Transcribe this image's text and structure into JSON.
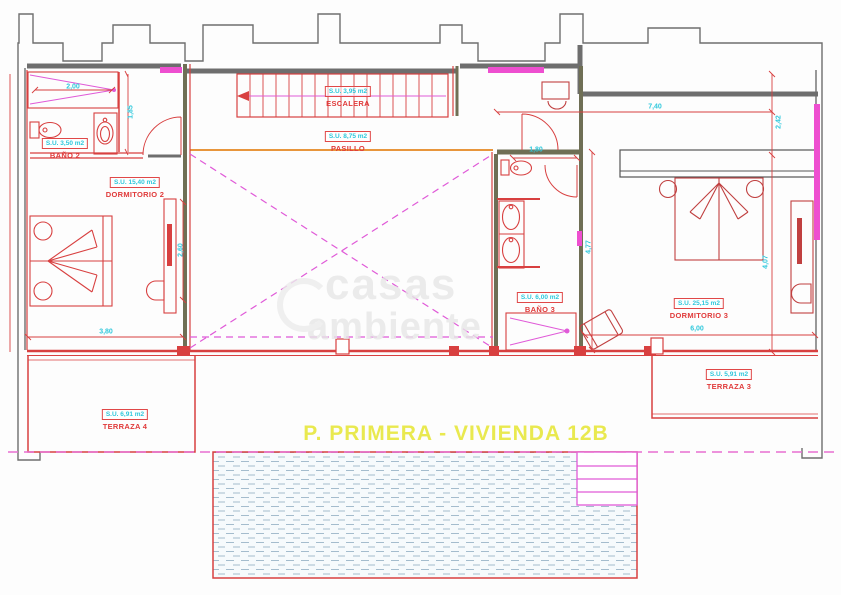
{
  "title": "P. PRIMERA - VIVIENDA 12B",
  "watermark": {
    "line1": "casas",
    "line2": "ambiente"
  },
  "rooms": [
    {
      "name": "BAÑO 2",
      "area": "S.U. 3,50 m2"
    },
    {
      "name": "DORMITORIO 2",
      "area": "S.U. 15,40 m2"
    },
    {
      "name": "ESCALERA",
      "area": "S.U. 3,95 m2"
    },
    {
      "name": "PASILLO",
      "area": "S.U. 8,75 m2"
    },
    {
      "name": "BAÑO 3",
      "area": "S.U. 6,00 m2"
    },
    {
      "name": "DORMITORIO 3",
      "area": "S.U. 25,15 m2"
    },
    {
      "name": "TERRAZA 4",
      "area": "S.U. 6,91 m2"
    },
    {
      "name": "TERRAZA 3",
      "area": "S.U. 5,91 m2"
    }
  ],
  "dimensions": [
    {
      "value": "2,00",
      "of": "bano2-shower-width"
    },
    {
      "value": "1,85",
      "of": "bano2-depth"
    },
    {
      "value": "2,60",
      "of": "dormitorio2-right-side"
    },
    {
      "value": "3,80",
      "of": "dormitorio2-width"
    },
    {
      "value": "1,80",
      "of": "bano3-width"
    },
    {
      "value": "4,77",
      "of": "bano3-depth"
    },
    {
      "value": "7,40",
      "of": "dormitorio3-top-width"
    },
    {
      "value": "2,42",
      "of": "dormitorio3-right-upper"
    },
    {
      "value": "4,07",
      "of": "dormitorio3-right-lower"
    },
    {
      "value": "6,00",
      "of": "dormitorio3-bottom-width"
    }
  ],
  "colors": {
    "exterior_walls": "#6e6e6e",
    "plan_red": "#d84040",
    "dimension_cyan": "#2fc8dc",
    "guide_magenta": "#e05ad8",
    "accent_orange": "#e8963c",
    "title_yellow": "#e9e94f"
  }
}
